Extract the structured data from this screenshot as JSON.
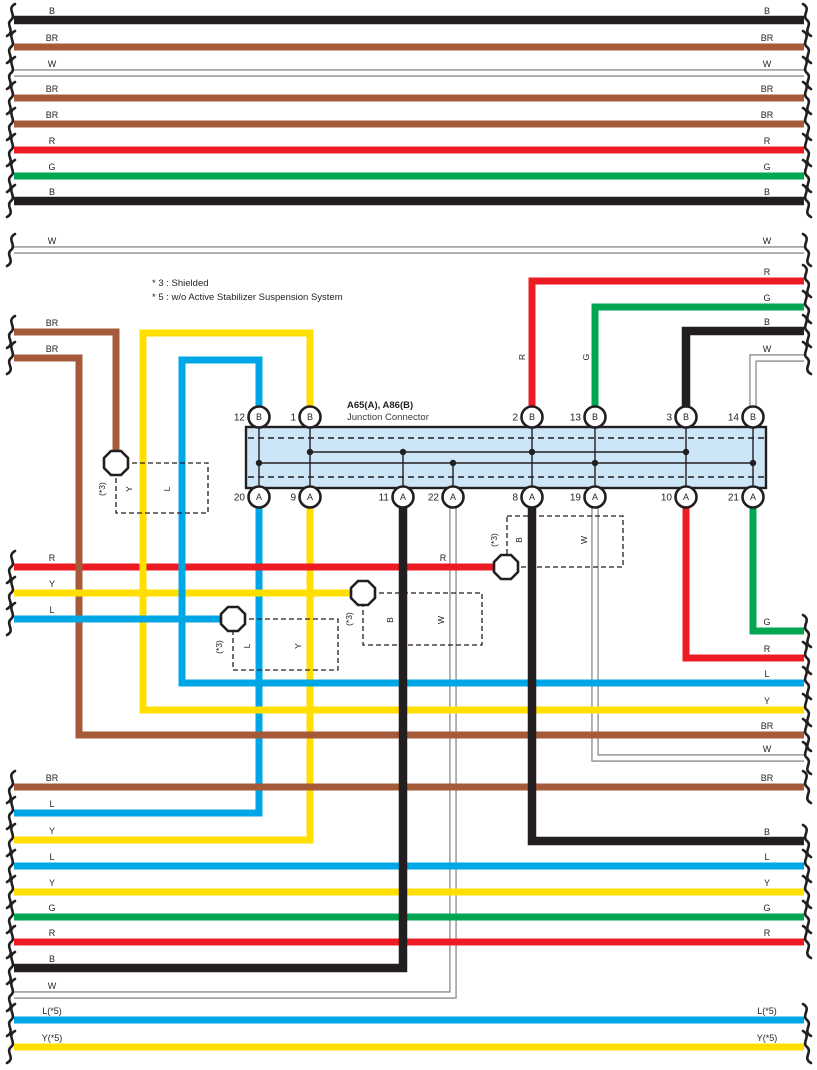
{
  "connector": {
    "title": "A65(A), A86(B)",
    "subtitle": "Junction Connector",
    "top_pins": [
      {
        "num": "12",
        "letter": "B"
      },
      {
        "num": "1",
        "letter": "B"
      },
      {
        "num": "2",
        "letter": "B"
      },
      {
        "num": "13",
        "letter": "B"
      },
      {
        "num": "3",
        "letter": "B"
      },
      {
        "num": "14",
        "letter": "B"
      }
    ],
    "bottom_pins": [
      {
        "num": "20",
        "letter": "A"
      },
      {
        "num": "9",
        "letter": "A"
      },
      {
        "num": "11",
        "letter": "A"
      },
      {
        "num": "22",
        "letter": "A"
      },
      {
        "num": "8",
        "letter": "A"
      },
      {
        "num": "19",
        "letter": "A"
      },
      {
        "num": "10",
        "letter": "A"
      },
      {
        "num": "21",
        "letter": "A"
      }
    ]
  },
  "notes": {
    "note3": "* 3 : Shielded",
    "note5": "* 5 : w/o Active Stabilizer Suspension System"
  },
  "left_labels": [
    "B",
    "BR",
    "W",
    "BR",
    "BR",
    "R",
    "G",
    "B",
    "W",
    "BR",
    "BR",
    "R",
    "Y",
    "L",
    "BR",
    "L",
    "Y",
    "L",
    "Y",
    "G",
    "R",
    "B",
    "W",
    "L(*5)",
    "Y(*5)"
  ],
  "right_labels": [
    "B",
    "BR",
    "W",
    "BR",
    "BR",
    "R",
    "G",
    "B",
    "W",
    "R",
    "G",
    "B",
    "W",
    "G",
    "R",
    "L",
    "Y",
    "BR",
    "W",
    "BR",
    "B",
    "L",
    "Y",
    "G",
    "R",
    "L(*5)",
    "Y(*5)"
  ],
  "shield_groups": [
    {
      "tag": "(*3)",
      "wires": [
        "Y",
        "L"
      ]
    },
    {
      "tag": "(*3)",
      "wires": [
        "L",
        "Y"
      ]
    },
    {
      "tag": "(*3)",
      "wires": [
        "B",
        "W"
      ]
    },
    {
      "tag": "(*3)",
      "wires": [
        "B",
        "W"
      ]
    }
  ],
  "vertical_labels": {
    "pin2_wire": "R",
    "pin13_wire": "G"
  },
  "mid_labels": {
    "r_near_shield4": "R"
  },
  "colors": {
    "ink": "#231f20",
    "black_wire": "#231f20",
    "brown": "#A55B3A",
    "red": "#ED1C24",
    "green": "#00A651",
    "yellow": "#FFDE00",
    "blue": "#00A7E7",
    "white_casing": "#8C8C8C",
    "connector_fill": "#CDE6F7"
  }
}
